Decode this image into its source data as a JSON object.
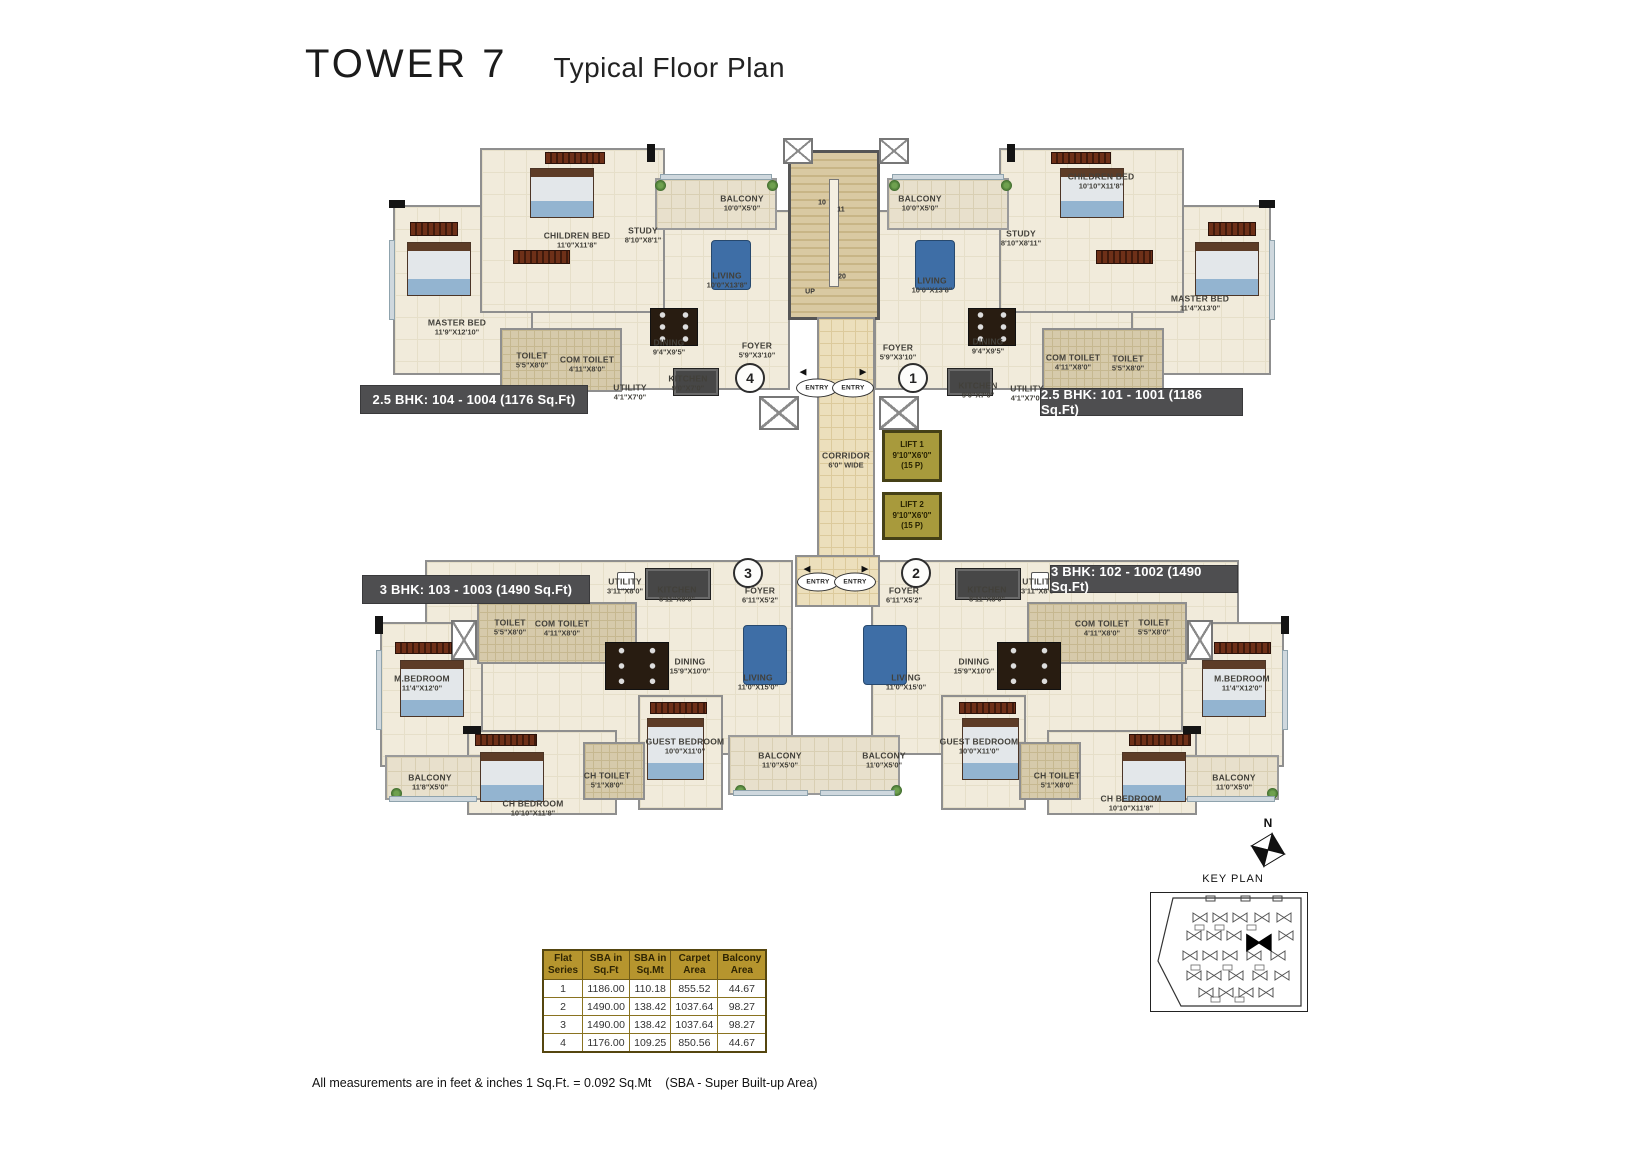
{
  "title": {
    "main": "TOWER 7",
    "subtitle": "Typical Floor Plan"
  },
  "units": [
    {
      "label": "2.5 BHK: 104 - 1004 (1176 Sq.Ft)"
    },
    {
      "label": "2.5 BHK: 101 - 1001 (1186 Sq.Ft)"
    },
    {
      "label": "3 BHK: 103 - 1003 (1490 Sq.Ft)"
    },
    {
      "label": "3 BHK: 102 - 1002 (1490 Sq.Ft)"
    }
  ],
  "plan": {
    "corridor": {
      "name": "CORRIDOR",
      "dims": "6'0\" WIDE",
      "x": 491,
      "y": 330
    },
    "lifts": [
      {
        "name": "LIFT 1",
        "dims": "9'10\"X6'0\"",
        "cap": "(15 P)"
      },
      {
        "name": "LIFT 2",
        "dims": "9'10\"X6'0\"",
        "cap": "(15 P)"
      }
    ],
    "entry_label": "ENTRY",
    "stair_labels": [
      {
        "t": "10",
        "x": 467,
        "y": 73
      },
      {
        "t": "11",
        "x": 486,
        "y": 80
      },
      {
        "t": "20",
        "x": 487,
        "y": 147
      },
      {
        "t": "UP",
        "x": 455,
        "y": 162
      }
    ],
    "flat_circles": [
      {
        "t": "4",
        "x": 395,
        "y": 248
      },
      {
        "t": "1",
        "x": 558,
        "y": 248
      },
      {
        "t": "3",
        "x": 393,
        "y": 443
      },
      {
        "t": "2",
        "x": 561,
        "y": 443
      }
    ],
    "entries": [
      {
        "x": 462,
        "y": 258
      },
      {
        "x": 498,
        "y": 258
      },
      {
        "x": 463,
        "y": 452
      },
      {
        "x": 500,
        "y": 452
      }
    ],
    "arrows": [
      {
        "g": "◀",
        "x": 448,
        "y": 242
      },
      {
        "g": "▶",
        "x": 508,
        "y": 242
      },
      {
        "g": "◀",
        "x": 452,
        "y": 439
      },
      {
        "g": "▶",
        "x": 510,
        "y": 439
      }
    ],
    "rooms": [
      {
        "n": "CHILDREN BED",
        "d": "11'0\"X11'8\"",
        "x": 222,
        "y": 110
      },
      {
        "n": "MASTER BED",
        "d": "11'9\"X12'10\"",
        "x": 102,
        "y": 197
      },
      {
        "n": "STUDY",
        "d": "8'10\"X8'1\"",
        "x": 288,
        "y": 105
      },
      {
        "n": "TOILET",
        "d": "5'5\"X8'0\"",
        "x": 177,
        "y": 230
      },
      {
        "n": "COM TOILET",
        "d": "4'11\"X8'0\"",
        "x": 232,
        "y": 234
      },
      {
        "n": "UTILITY",
        "d": "4'1\"X7'0\"",
        "x": 275,
        "y": 262
      },
      {
        "n": "DINING",
        "d": "9'4\"X9'5\"",
        "x": 314,
        "y": 217
      },
      {
        "n": "KITCHEN",
        "d": "9'0\"X7'0\"",
        "x": 333,
        "y": 253
      },
      {
        "n": "LIVING",
        "d": "10'0\"X13'8\"",
        "x": 372,
        "y": 150
      },
      {
        "n": "BALCONY",
        "d": "10'0\"X5'0\"",
        "x": 387,
        "y": 73
      },
      {
        "n": "FOYER",
        "d": "5'9\"X3'10\"",
        "x": 402,
        "y": 220
      },
      {
        "n": "BALCONY",
        "d": "10'0\"X5'0\"",
        "x": 565,
        "y": 73
      },
      {
        "n": "LIVING",
        "d": "10'0\"X13'8\"",
        "x": 577,
        "y": 155
      },
      {
        "n": "CHILDREN BED",
        "d": "10'10\"X11'8\"",
        "x": 746,
        "y": 51
      },
      {
        "n": "STUDY",
        "d": "8'10\"X8'11\"",
        "x": 666,
        "y": 108
      },
      {
        "n": "MASTER BED",
        "d": "11'4\"X13'0\"",
        "x": 845,
        "y": 173
      },
      {
        "n": "DINING",
        "d": "9'4\"X9'5\"",
        "x": 633,
        "y": 216
      },
      {
        "n": "COM TOILET",
        "d": "4'11\"X8'0\"",
        "x": 718,
        "y": 232
      },
      {
        "n": "TOILET",
        "d": "5'5\"X8'0\"",
        "x": 773,
        "y": 233
      },
      {
        "n": "KITCHEN",
        "d": "9'0\"X7'0\"",
        "x": 623,
        "y": 260
      },
      {
        "n": "UTILITY",
        "d": "4'1\"X7'0\"",
        "x": 672,
        "y": 263
      },
      {
        "n": "FOYER",
        "d": "5'9\"X3'10\"",
        "x": 543,
        "y": 222
      },
      {
        "n": "UTILITY",
        "d": "3'11\"X8'0\"",
        "x": 270,
        "y": 456
      },
      {
        "n": "KITCHEN",
        "d": "8'11\"X8'0\"",
        "x": 322,
        "y": 464
      },
      {
        "n": "FOYER",
        "d": "6'11\"X5'2\"",
        "x": 405,
        "y": 465
      },
      {
        "n": "TOILET",
        "d": "5'5\"X8'0\"",
        "x": 155,
        "y": 497
      },
      {
        "n": "COM TOILET",
        "d": "4'11\"X8'0\"",
        "x": 207,
        "y": 498
      },
      {
        "n": "M.BEDROOM",
        "d": "11'4\"X12'0\"",
        "x": 67,
        "y": 553
      },
      {
        "n": "DINING",
        "d": "15'9\"X10'0\"",
        "x": 335,
        "y": 536
      },
      {
        "n": "LIVING",
        "d": "11'0\"X15'0\"",
        "x": 403,
        "y": 552
      },
      {
        "n": "GUEST BEDROOM",
        "d": "10'0\"X11'0\"",
        "x": 330,
        "y": 616
      },
      {
        "n": "BALCONY",
        "d": "11'8\"X5'0\"",
        "x": 75,
        "y": 652
      },
      {
        "n": "CH BEDROOM",
        "d": "10'10\"X11'8\"",
        "x": 178,
        "y": 678
      },
      {
        "n": "CH TOILET",
        "d": "5'1\"X8'0\"",
        "x": 252,
        "y": 650
      },
      {
        "n": "BALCONY",
        "d": "11'0\"X5'0\"",
        "x": 425,
        "y": 630
      },
      {
        "n": "UTILITY",
        "d": "3'11\"X8'0\"",
        "x": 684,
        "y": 456
      },
      {
        "n": "KITCHEN",
        "d": "8'11\"X8'0\"",
        "x": 632,
        "y": 464
      },
      {
        "n": "FOYER",
        "d": "6'11\"X5'2\"",
        "x": 549,
        "y": 465
      },
      {
        "n": "TOILET",
        "d": "5'5\"X8'0\"",
        "x": 799,
        "y": 497
      },
      {
        "n": "COM TOILET",
        "d": "4'11\"X8'0\"",
        "x": 747,
        "y": 498
      },
      {
        "n": "M.BEDROOM",
        "d": "11'4\"X12'0\"",
        "x": 887,
        "y": 553
      },
      {
        "n": "DINING",
        "d": "15'9\"X10'0\"",
        "x": 619,
        "y": 536
      },
      {
        "n": "LIVING",
        "d": "11'0\"X15'0\"",
        "x": 551,
        "y": 552
      },
      {
        "n": "GUEST BEDROOM",
        "d": "10'0\"X11'0\"",
        "x": 624,
        "y": 616
      },
      {
        "n": "BALCONY",
        "d": "11'0\"X5'0\"",
        "x": 879,
        "y": 652
      },
      {
        "n": "CH BEDROOM",
        "d": "10'10\"X11'8\"",
        "x": 776,
        "y": 673
      },
      {
        "n": "CH TOILET",
        "d": "5'1\"X8'0\"",
        "x": 702,
        "y": 650
      },
      {
        "n": "BALCONY",
        "d": "11'0\"X5'0\"",
        "x": 529,
        "y": 630
      }
    ]
  },
  "key_plan": {
    "title": "KEY PLAN",
    "compass_label": "N"
  },
  "table": {
    "headers": [
      [
        "Flat",
        "Series"
      ],
      [
        "SBA in",
        "Sq.Ft"
      ],
      [
        "SBA in",
        "Sq.Mt"
      ],
      [
        "Carpet",
        "Area"
      ],
      [
        "Balcony",
        "Area"
      ]
    ],
    "rows": [
      [
        "1",
        "1186.00",
        "110.18",
        "855.52",
        "44.67"
      ],
      [
        "2",
        "1490.00",
        "138.42",
        "1037.64",
        "98.27"
      ],
      [
        "3",
        "1490.00",
        "138.42",
        "1037.64",
        "98.27"
      ],
      [
        "4",
        "1176.00",
        "109.25",
        "850.56",
        "44.67"
      ]
    ]
  },
  "footnote": "All measurements are in feet & inches 1 Sq.Ft. = 0.092 Sq.Mt    (SBA - Super Built-up Area)"
}
